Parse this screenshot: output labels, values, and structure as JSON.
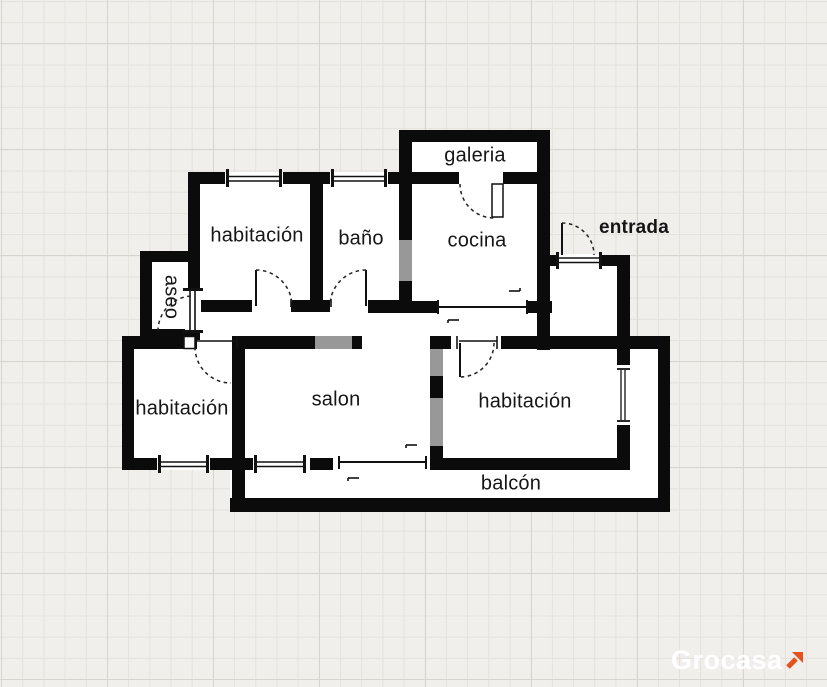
{
  "plan": {
    "type": "floorplan",
    "rooms": [
      {
        "id": "galeria",
        "label": "galeria"
      },
      {
        "id": "habitacion-top",
        "label": "habitación"
      },
      {
        "id": "bano",
        "label": "baño"
      },
      {
        "id": "cocina",
        "label": "cocina"
      },
      {
        "id": "entrada",
        "label": "entrada"
      },
      {
        "id": "aseo",
        "label": "aseo"
      },
      {
        "id": "habitacion-left",
        "label": "habitación"
      },
      {
        "id": "salon",
        "label": "salon"
      },
      {
        "id": "habitacion-right",
        "label": "habitación"
      },
      {
        "id": "balcon",
        "label": "balcón"
      }
    ],
    "colors": {
      "wall": "#0b0b0b",
      "room_fill": "#ffffff",
      "background": "#f0efeb",
      "grid_line": "#e5e2dd",
      "grid_major_line": "#d8d5cf",
      "label_text": "#161616"
    }
  },
  "brand": {
    "name": "Grocasa",
    "text_color": "#ffffff",
    "arrow_color": "#e8501e",
    "arrow_icon": "arrow-up-right"
  }
}
